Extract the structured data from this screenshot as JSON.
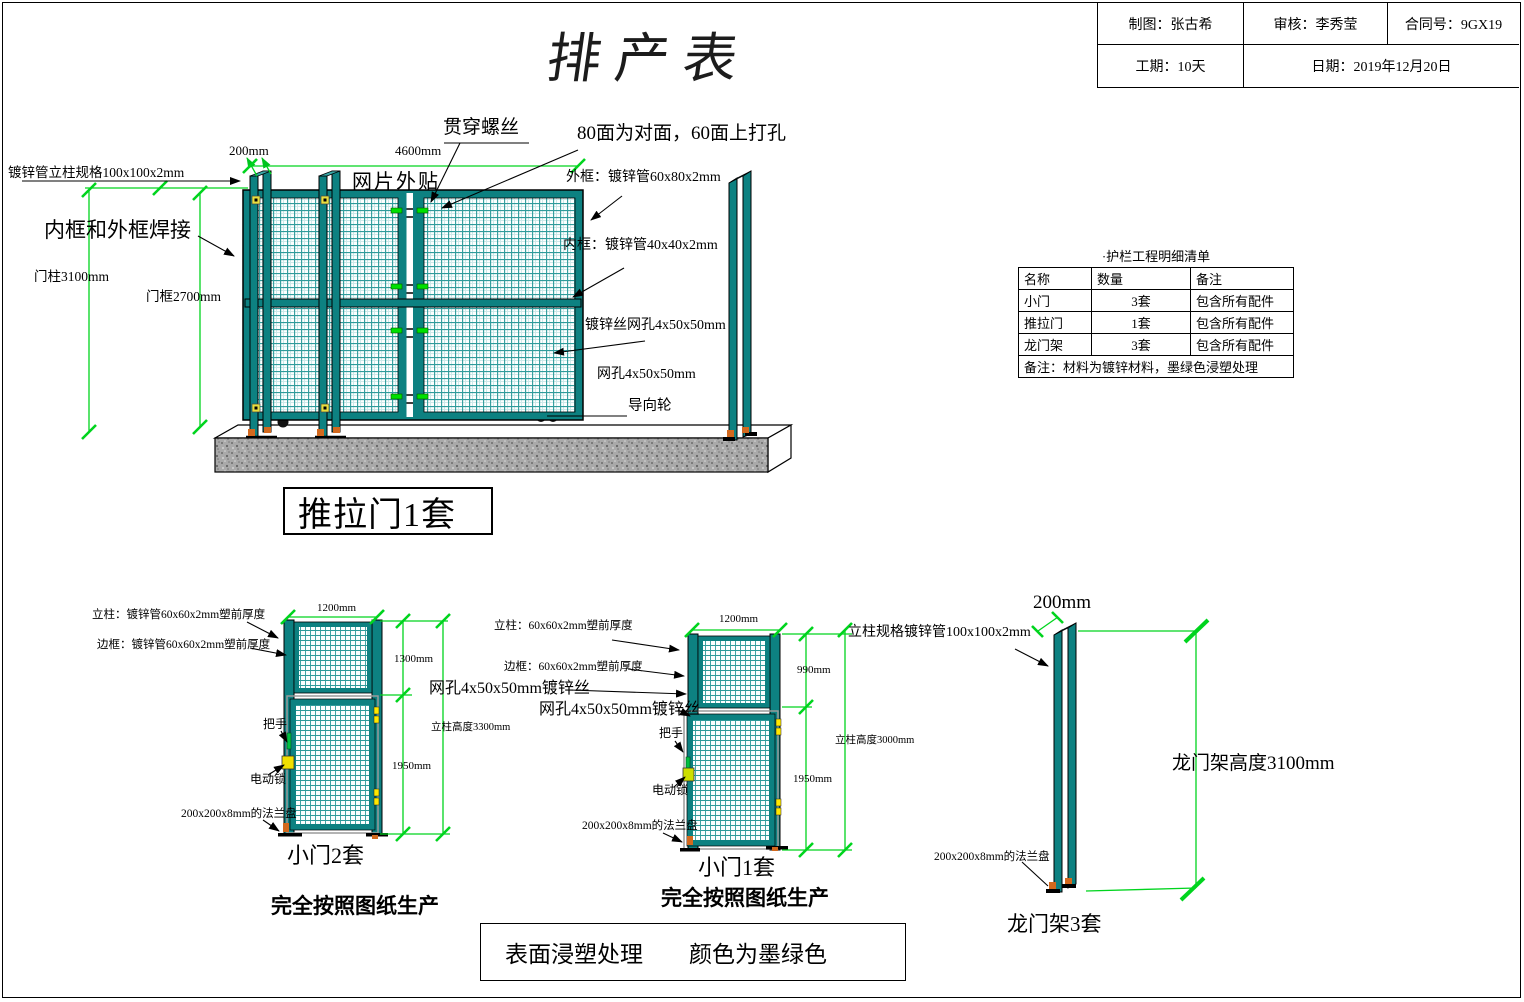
{
  "sheet": {
    "title": "排产表",
    "title_block": {
      "drafter": "制图：张古希",
      "reviewer": "审核：李秀莹",
      "contract_no": "合同号：9GX19",
      "duration": "工期：10天",
      "date": "日期：2019年12月20日"
    }
  },
  "colors": {
    "frame_teal": "#0d8181",
    "dimension_green": "#00d41e",
    "accent_yellow": "#f0e000",
    "flange_orange": "#d2691e"
  },
  "main_view": {
    "caption": "推拉门1套",
    "labels": {
      "post_spec": "镀锌管立柱规格100x100x2mm",
      "weld_note": "内框和外框焊接",
      "door_post_height": "门柱3100mm",
      "door_frame_height": "门框2700mm",
      "dim_post_width": "200mm",
      "dim_gate_width": "4600mm",
      "through_screw": "贯穿螺丝",
      "drill_note": "80面为对面，60面上打孔",
      "mesh_attach": "网片外贴",
      "outer_frame": "外框：镀锌管60x80x2mm",
      "inner_frame": "内框：镀锌管40x40x2mm",
      "mesh_wire": "镀锌丝网孔4x50x50mm",
      "mesh_hole": "网孔4x50x50mm",
      "guide_wheel": "导向轮"
    }
  },
  "parts_table": {
    "title": "·护栏工程明细清单",
    "headers": [
      "名称",
      "数量",
      "备注"
    ],
    "rows": [
      {
        "name": "小门",
        "qty": "3套",
        "note": "包含所有配件"
      },
      {
        "name": "推拉门",
        "qty": "1套",
        "note": "包含所有配件"
      },
      {
        "name": "龙门架",
        "qty": "3套",
        "note": "包含所有配件"
      }
    ],
    "footer": "备注：材料为镀锌材料，墨绿色浸塑处理"
  },
  "door2": {
    "labels": {
      "post_spec": "立柱：镀锌管60x60x2mm塑前厚度",
      "frame_spec": "边框：镀锌管60x60x2mm塑前厚度",
      "handle": "把手",
      "lock": "电动锁",
      "flange": "200x200x8mm的法兰盘",
      "dim_width": "1200mm",
      "dim_top": "1300mm",
      "dim_bottom": "1950mm",
      "post_height": "立柱高度3300mm"
    },
    "caption": "小门2套",
    "note": "完全按照图纸生产"
  },
  "door1": {
    "labels": {
      "post_spec": "立柱：60x60x2mm塑前厚度",
      "frame_spec": "边框：60x60x2mm塑前厚度",
      "mesh_upper": "网孔4x50x50mm镀锌丝",
      "mesh_lower": "网孔4x50x50mm镀锌丝",
      "handle": "把手",
      "lock": "电动锁",
      "flange": "200x200x8mm的法兰盘",
      "dim_width": "1200mm",
      "dim_top": "990mm",
      "dim_bottom": "1950mm",
      "post_height": "立柱高度3000mm"
    },
    "caption": "小门1套",
    "note": "完全按照图纸生产"
  },
  "gantry": {
    "labels": {
      "dim_width": "200mm",
      "post_spec": "立柱规格镀锌管100x100x2mm",
      "height": "龙门架高度3100mm",
      "flange": "200x200x8mm的法兰盘"
    },
    "caption": "龙门架3套"
  },
  "footer_note": "表面浸塑处理　　颜色为墨绿色"
}
